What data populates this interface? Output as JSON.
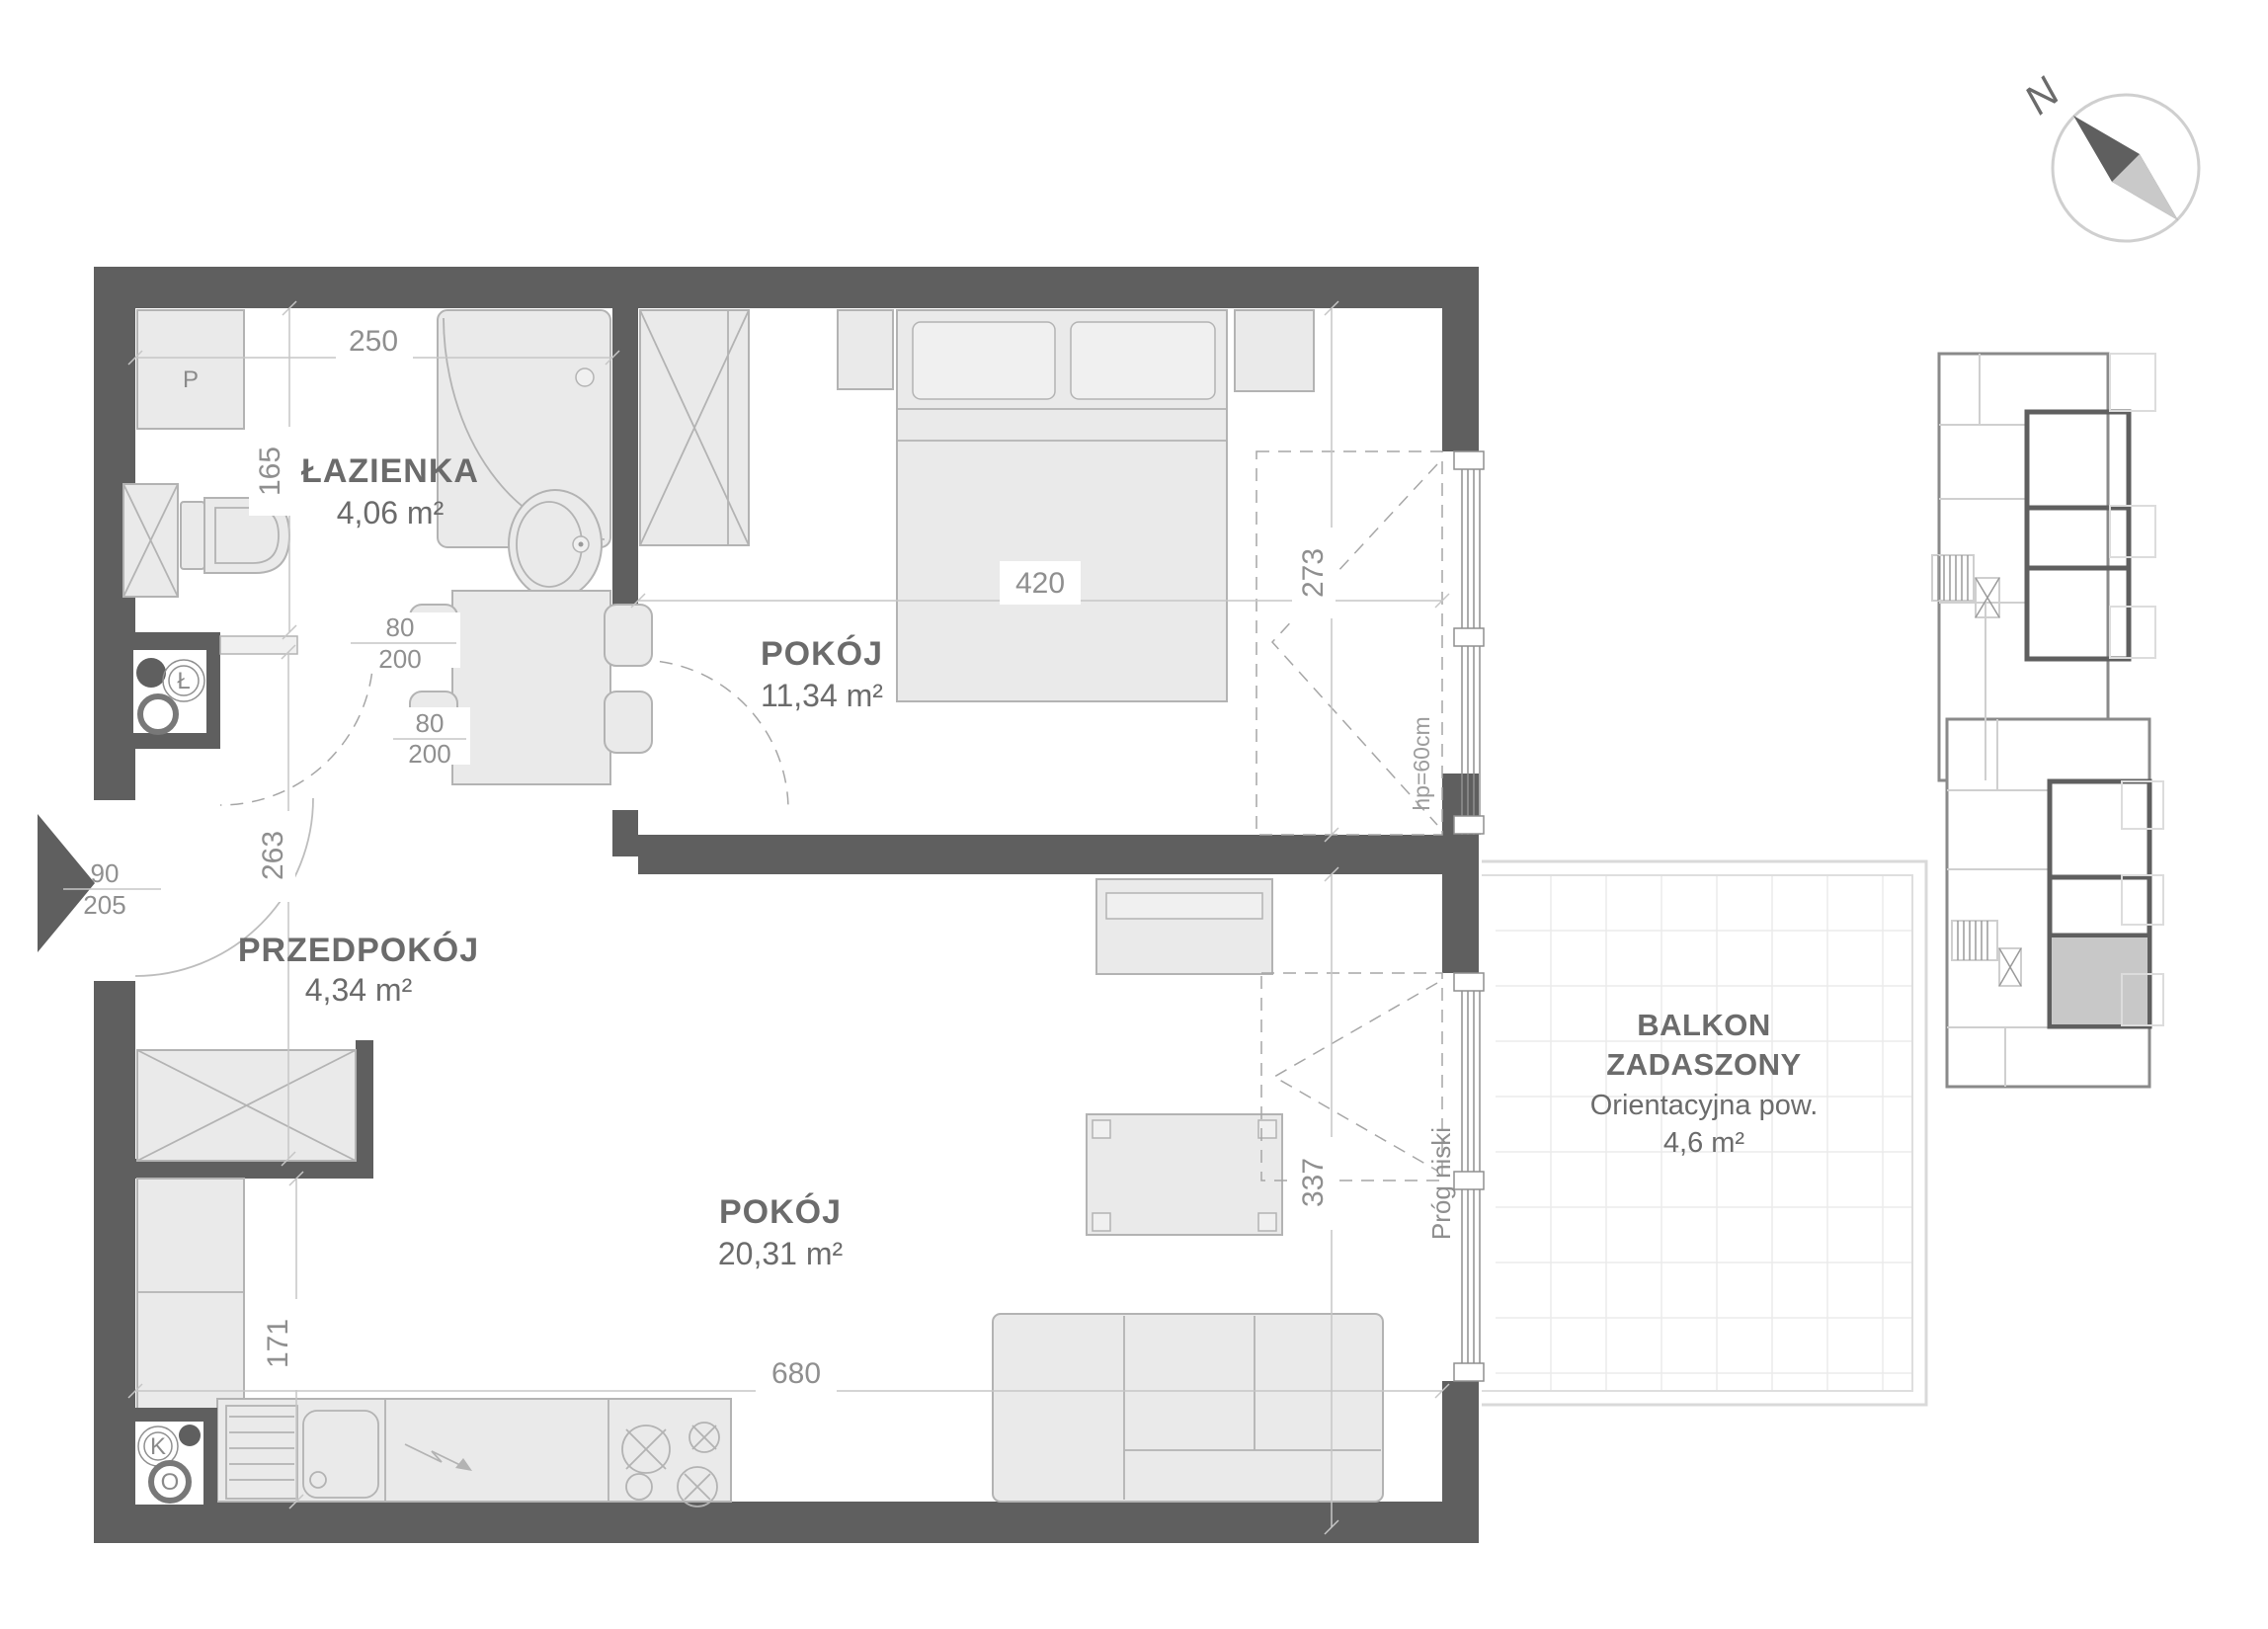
{
  "floorplan": {
    "rooms": {
      "bathroom": {
        "name": "ŁAZIENKA",
        "area": "4,06 m²"
      },
      "bedroom": {
        "name": "POKÓJ",
        "area": "11,34 m²"
      },
      "hall": {
        "name": "PRZEDPOKÓJ",
        "area": "4,34 m²"
      },
      "living": {
        "name": "POKÓJ",
        "area": "20,31 m²"
      }
    },
    "balcony": {
      "title_line1": "BALKON",
      "title_line2": "ZADASZONY",
      "note": "Orientacyjna pow.",
      "area": "4,6 m²"
    },
    "dimensions": {
      "bathroom_width_cm": "250",
      "bathroom_depth_cm": "165",
      "bedroom_width_cm": "420",
      "bedroom_depth_cm": "273",
      "hall_length_cm": "263",
      "living_width_cm": "680",
      "kitchen_depth_cm": "171",
      "living_depth_cm": "337"
    },
    "doors": {
      "entry": {
        "width": "90",
        "height": "205"
      },
      "bathroom": {
        "width": "80",
        "height": "200"
      },
      "bedroom": {
        "width": "80",
        "height": "200"
      }
    },
    "labels": {
      "window_sill_height": "hp=60cm",
      "threshold": "Próg niski"
    },
    "symbols": {
      "washing_machine": "P",
      "vent_bathroom": "Ł",
      "vent_kitchen": "K",
      "vent_extract": "O",
      "north": "N"
    },
    "colors": {
      "wall": "#5f5f5f",
      "furniture_fill": "#eaeaea",
      "furniture_stroke": "#b3b3b3",
      "dimension": "#8f8f8f",
      "room_label": "#6b6b6b",
      "keyplan_highlight": "#c8c8c8"
    }
  }
}
